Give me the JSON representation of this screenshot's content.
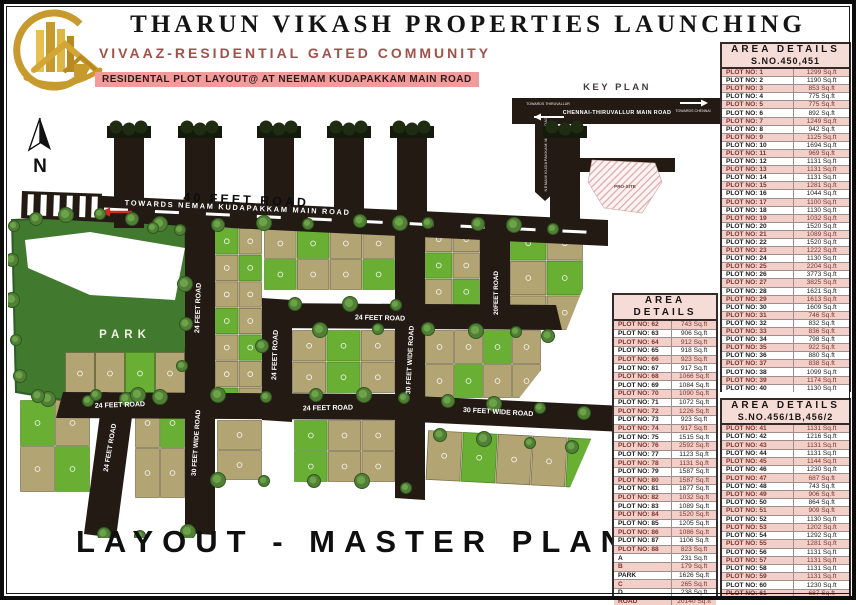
{
  "header": {
    "title": "THARUN VIKASH PROPERTIES LAUNCHING",
    "subtitle": "VIVAAZ-RESIDENTIAL GATED COMMUNITY",
    "tagline": "RESIDENTAL PLOT LAYOUT@ AT NEEMAM KUDAPAKKAM MAIN ROAD"
  },
  "key_plan": {
    "title": "KEY PLAN",
    "main_road": "CHENNAI-THIRUVALLUR MAIN ROAD",
    "towards_left": "TOWARDS THIRUVALLUR",
    "towards_right": "TOWARDS CHENNAI",
    "vertical_road": "NEMAM KUDAPAKKAM MAIN ROAD",
    "site_label": "PRO-SITE"
  },
  "map": {
    "north": "N",
    "park_label": "PARK",
    "road_labels": [
      "40 FEET ROAD",
      "TOWARDS NEMAM KUDAPAKKAM MAIN ROAD",
      "24 FEET ROAD",
      "24 FEET ROAD",
      "30 FEET WIDE ROAD",
      "20FEET ROAD",
      "24 FEET ROAD",
      "24 FEET ROAD",
      "24 FEET ROAD",
      "30 FEET WIDE ROAD",
      "24 FEET ROAD",
      "30 FEET WIDE ROAD"
    ]
  },
  "footer": {
    "title": "LAYOUT - MASTER PLAN"
  },
  "colors": {
    "road": "#231a14",
    "plot_tan": "#b3a474",
    "plot_green": "#69af33",
    "park_green": "#41792f",
    "table_pink": "#f3cfc9",
    "accent_maroon": "#a0524a",
    "tagline_pink": "#f19b9b",
    "logo_gold": "#c79a2e"
  },
  "tables": [
    {
      "title": "AREA DETAILS",
      "subtitle": "S.NO.450,451",
      "row_prefix": "PLOT NO:",
      "unit": "Sq.ft",
      "plots": [
        [
          1,
          1299
        ],
        [
          2,
          1190
        ],
        [
          3,
          853
        ],
        [
          4,
          775
        ],
        [
          5,
          775
        ],
        [
          6,
          892
        ],
        [
          7,
          1249
        ],
        [
          8,
          942
        ],
        [
          9,
          1125
        ],
        [
          10,
          1694
        ],
        [
          11,
          969
        ],
        [
          12,
          1131
        ],
        [
          13,
          1131
        ],
        [
          14,
          1131
        ],
        [
          15,
          1281
        ],
        [
          16,
          1044
        ],
        [
          17,
          1100
        ],
        [
          18,
          1130
        ],
        [
          19,
          1032
        ],
        [
          20,
          1520
        ],
        [
          21,
          1089
        ],
        [
          22,
          1520
        ],
        [
          23,
          1222
        ],
        [
          24,
          1130
        ],
        [
          25,
          2204
        ],
        [
          26,
          3773
        ],
        [
          27,
          3825
        ],
        [
          28,
          1621
        ],
        [
          29,
          1613
        ],
        [
          30,
          1609
        ],
        [
          31,
          746
        ],
        [
          32,
          832
        ],
        [
          33,
          836
        ],
        [
          34,
          798
        ],
        [
          35,
          922
        ],
        [
          36,
          880
        ],
        [
          37,
          838
        ],
        [
          38,
          1099
        ],
        [
          39,
          1174
        ],
        [
          40,
          1130
        ]
      ],
      "extras": []
    },
    {
      "title": "AREA DETAILS",
      "subtitle": "",
      "row_prefix": "PLOT NO:",
      "unit": "Sq.ft",
      "plots": [
        [
          62,
          743
        ],
        [
          63,
          906
        ],
        [
          64,
          912
        ],
        [
          65,
          918
        ],
        [
          66,
          923
        ],
        [
          67,
          917
        ],
        [
          68,
          1066
        ],
        [
          69,
          1084
        ],
        [
          70,
          1090
        ],
        [
          71,
          1072
        ],
        [
          72,
          1226
        ],
        [
          73,
          923
        ],
        [
          74,
          917
        ],
        [
          75,
          1515
        ],
        [
          76,
          2592
        ],
        [
          77,
          1123
        ],
        [
          78,
          1131
        ],
        [
          79,
          1587
        ],
        [
          80,
          1587
        ],
        [
          81,
          1877
        ],
        [
          82,
          1032
        ],
        [
          83,
          1089
        ],
        [
          84,
          1520
        ],
        [
          85,
          1205
        ],
        [
          86,
          1086
        ],
        [
          87,
          1106
        ],
        [
          88,
          823
        ]
      ],
      "extras": [
        [
          "A",
          231
        ],
        [
          "B",
          179
        ],
        [
          "PARK",
          1626
        ],
        [
          "C",
          265
        ],
        [
          "D",
          238
        ],
        [
          "ROAD",
          20140
        ]
      ]
    },
    {
      "title": "AREA DETAILS",
      "subtitle": "S.NO.456/1B,456/2",
      "row_prefix": "PLOT NO:",
      "unit": "Sq.ft",
      "plots": [
        [
          41,
          1131
        ],
        [
          42,
          1216
        ],
        [
          43,
          1131
        ],
        [
          44,
          1131
        ],
        [
          45,
          1144
        ],
        [
          46,
          1230
        ],
        [
          47,
          687
        ],
        [
          48,
          743
        ],
        [
          49,
          906
        ],
        [
          50,
          864
        ],
        [
          51,
          909
        ],
        [
          52,
          1130
        ],
        [
          53,
          1202
        ],
        [
          54,
          1292
        ],
        [
          55,
          1281
        ],
        [
          56,
          1131
        ],
        [
          57,
          1131
        ],
        [
          58,
          1131
        ],
        [
          59,
          1131
        ],
        [
          60,
          1230
        ],
        [
          61,
          687
        ]
      ],
      "extras": []
    }
  ]
}
